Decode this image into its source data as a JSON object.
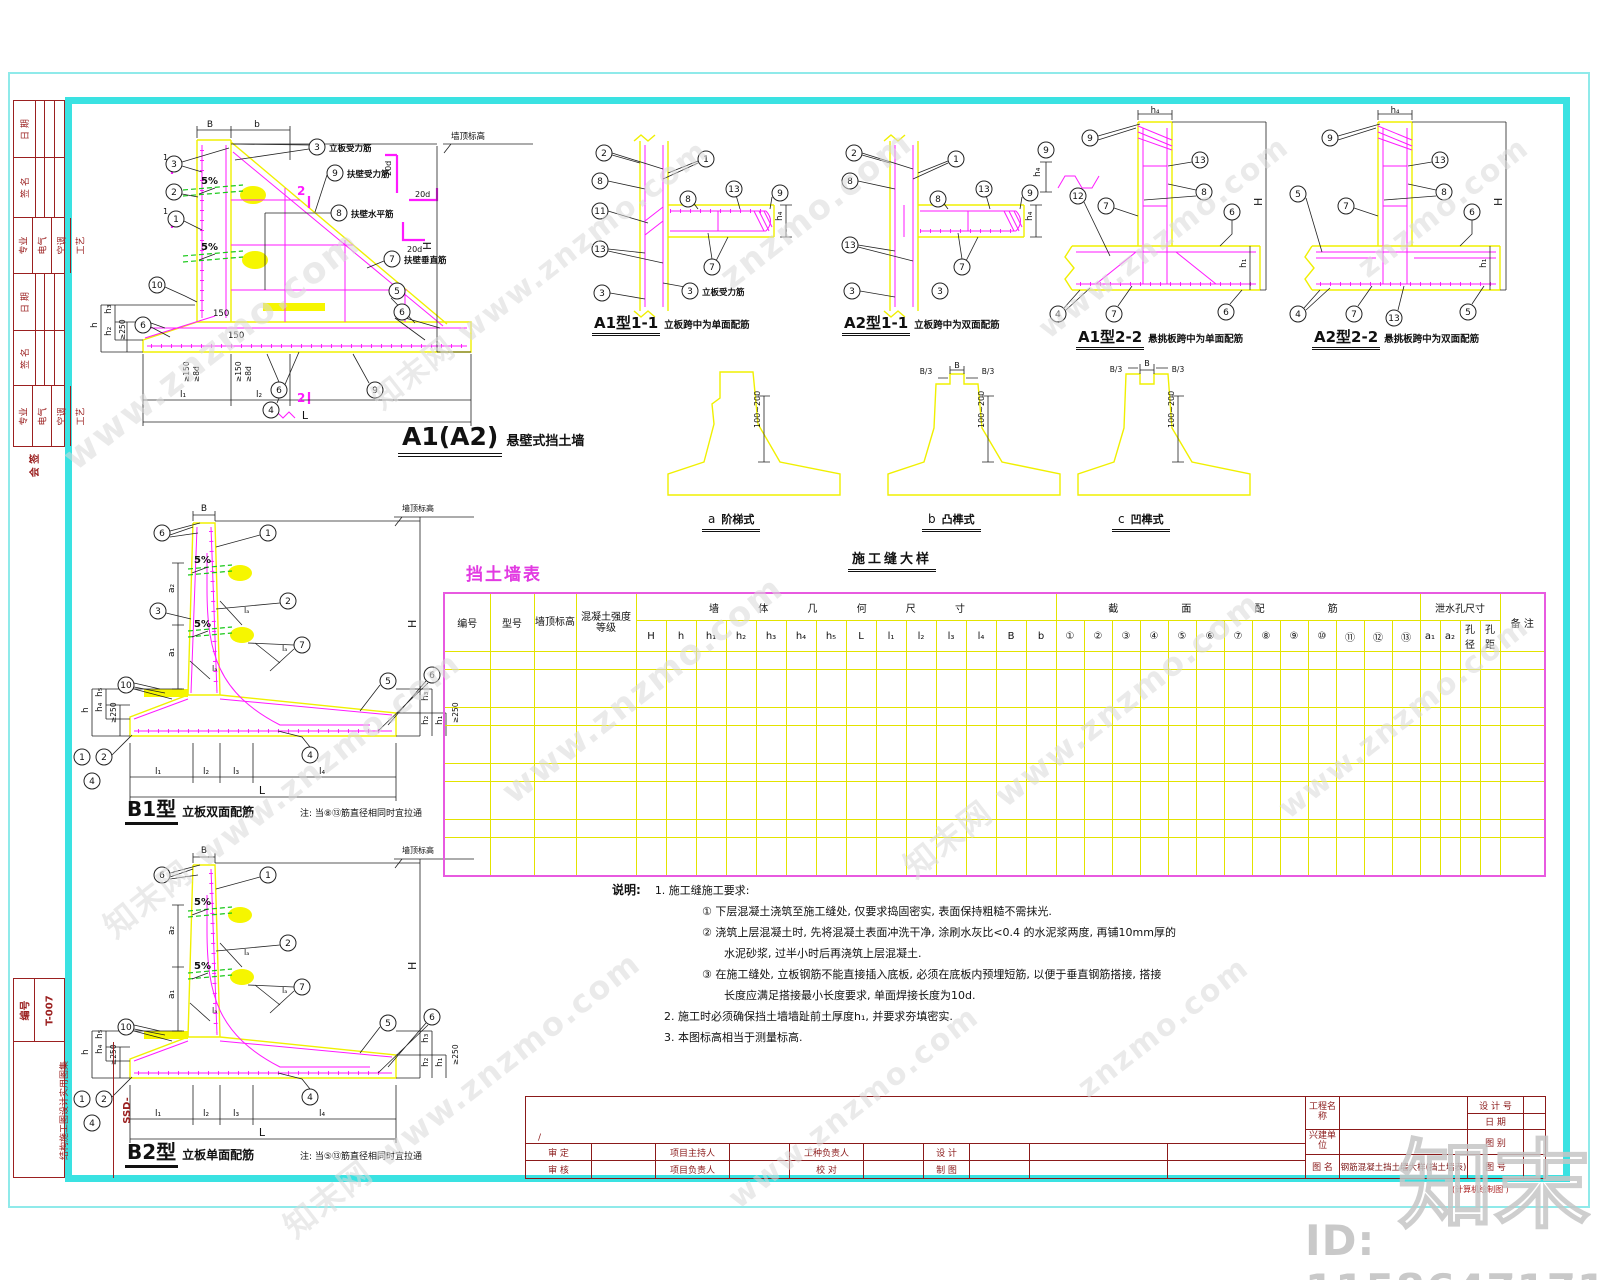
{
  "page": {
    "wm_full": "知末网 www.znzmo.com",
    "wm_url": "www.znzmo.com",
    "wm_short": "znzmo.com",
    "logo": "知末",
    "id_text": "ID: 1158647171",
    "cad_note": "(计算机绘制图    )"
  },
  "c": {
    "1": "1",
    "2": "2",
    "3": "3",
    "4": "4",
    "5": "5",
    "6": "6",
    "7": "7",
    "8": "8",
    "9": "9",
    "10": "10",
    "11": "11",
    "12": "12",
    "13": "13"
  },
  "d": {
    "B": "B",
    "b": "b",
    "H": "H",
    "h": "h",
    "h1": "h₁",
    "h2": "h₂",
    "h3": "h₃",
    "h4": "h₄",
    "h5": "h₅",
    "L": "L",
    "l1": "l₁",
    "l2": "l₂",
    "l3": "l₃",
    "l4": "l₄",
    "a1": "a₁",
    "a2": "a₂",
    "la": "lₐ",
    "pct": "5%",
    "d20": "20d",
    "n150": "150",
    "ge150": "≥150",
    "ge8d": "≥8d",
    "ge250": "≥250",
    "range": "100~200",
    "B3": "B/3",
    "te": "墙顶标高",
    "s1": "1",
    "s2": "2"
  },
  "main": {
    "code": "A1(A2)",
    "name": "悬壁式挡土墙",
    "r3": "立板受力筋",
    "r9": "扶壁受力筋",
    "r8": "扶壁水平筋",
    "r7": "扶壁垂直筋"
  },
  "sec": {
    "a111": "A1型1-1",
    "a111d": "立板跨中为单面配筋",
    "a211": "A2型1-1",
    "a211d": "立板跨中为双面配筋",
    "a122": "A1型2-2",
    "a122d": "悬挑板跨中为单面配筋",
    "a222": "A2型2-2",
    "a222d": "悬挑板跨中为双面配筋"
  },
  "joint": {
    "title": "施工缝大样",
    "a": "a",
    "an": "阶梯式",
    "b": "b",
    "bn": "凸榫式",
    "cc": "c",
    "cn": "凹榫式"
  },
  "b1": {
    "code": "B1型",
    "name": "立板双面配筋",
    "note": "注: 当⑧⑬筋直径相同时宜拉通"
  },
  "b2": {
    "code": "B2型",
    "name": "立板单面配筋",
    "note": "注: 当⑤⑬筋直径相同时宜拉通"
  },
  "table": {
    "title": "挡土墙表",
    "no": "编号",
    "type": "型号",
    "elev": "墙顶标高",
    "grade": "混凝土强度等级",
    "geom": "墙 体 几 何 尺 寸",
    "rebar": "截 面 配 筋",
    "hole": "泄水孔尺寸",
    "remark": "备 注",
    "geom_cols": [
      "H",
      "h",
      "h₁",
      "h₂",
      "h₃",
      "h₄",
      "h₅",
      "L",
      "l₁",
      "l₂",
      "l₃",
      "l₄",
      "B",
      "b"
    ],
    "rebar_cols": [
      "①",
      "②",
      "③",
      "④",
      "⑤",
      "⑥",
      "⑦",
      "⑧",
      "⑨",
      "⑩",
      "⑪",
      "⑫",
      "⑬"
    ],
    "hole_cols": [
      "a₁",
      "a₂",
      "孔径",
      "孔距"
    ],
    "empty_rows": 8
  },
  "notes": {
    "label": "说明:",
    "l1": "1.   施工缝施工要求:",
    "l2": "①  下层混凝土浇筑至施工缝处, 仅要求捣固密实, 表面保持粗糙不需抹光.",
    "l3": "②  浇筑上层混凝土时, 先将混凝土表面冲洗干净, 涂刷水灰比<0.4 的水泥浆两度, 再铺10mm厚的",
    "l4": "水泥砂浆, 过半小时后再浇筑上层混凝土.",
    "l5": "③  在施工缝处, 立板钢筋不能直接插入底板, 必须在底板内预埋短筋, 以便于垂直钢筋搭接, 搭接",
    "l6": "长度应满足搭接最小长度要求, 单面焊接长度为10d.",
    "l7": "2.   施工时必须确保挡土墙墙趾前土厚度h₁, 并要求夯填密实.",
    "l8": "3.   本图标高相当于测量标高."
  },
  "tb": {
    "slash": "/",
    "shending": "审  定",
    "shenhe": "审  核",
    "zhuchiren": "项目主持人",
    "fuzeren": "项目负责人",
    "gongzhong": "工种负责人",
    "jiaodui": "校   对",
    "sheji": "设  计",
    "zhitu": "制  图",
    "proj": "工程名称",
    "unit": "兴建单位",
    "tuming": "图 名",
    "shejihao": "设 计 号",
    "riqi": "日  期",
    "tubie": "图  别",
    "tuhao": "图  号",
    "name_value": "钢筋混凝土挡土墙大样(挡土墙表)"
  },
  "sidebar": {
    "b1": "日 期",
    "b2": "签 名",
    "s1": "专业",
    "s2": "电气",
    "s3": "空调",
    "s4": "工艺",
    "b4": "日 期",
    "b5": "签 名",
    "heqian": "会 签",
    "code_label": "编号",
    "code_value": "T-007",
    "series_label": "结构施工图设计实用图集",
    "series_value": "SSD-"
  }
}
